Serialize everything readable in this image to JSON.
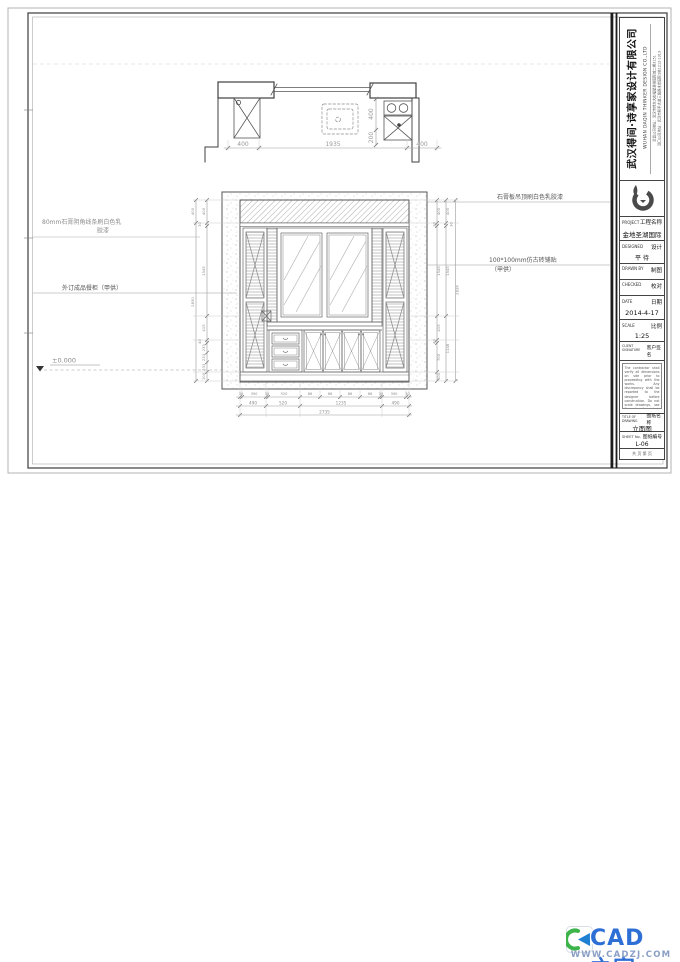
{
  "plan": {
    "dims_bottom": [
      "400",
      "1935",
      "400"
    ],
    "dims_right": [
      "400",
      "200"
    ]
  },
  "elev": {
    "left_inner": [
      "400",
      "30",
      "1545",
      "415",
      "40",
      "233",
      "233",
      "233",
      "100"
    ],
    "left_outer": [
      "400",
      "2830"
    ],
    "right_inner": [
      "400",
      "30",
      "1545",
      "415",
      "40",
      "700",
      "100"
    ],
    "right_outer": [
      "400",
      "30",
      "1545",
      "1148"
    ],
    "right_overall": "2836",
    "bottom_row1": [
      "30",
      "390",
      "30",
      "520",
      "86",
      "86",
      "86",
      "86",
      "30",
      "390",
      "30"
    ],
    "bottom_row2": [
      "490",
      "520",
      "1235",
      "490"
    ],
    "bottom_overall": "2735"
  },
  "ann": {
    "left1a": "80mm石膏阴角线条刷白色乳",
    "left1b": "胶漆",
    "left2": "外订成品餐柜（甲供）",
    "right1": "石膏板吊顶刷白色乳胶漆",
    "right2a": "100*100mm仿古砖铺贴",
    "right2b": "（甲供）",
    "level": "±0.000"
  },
  "tb": {
    "company_cn": "武汉得间·诗享家设计有限公司",
    "company_en": "WUHAN DAQIN THINKER DESIGN CO.,LTD",
    "address1": "武昌公司地址：武汉市徐东大街福星惠誉国际城二期3151",
    "address2": "汉口公司地址：武汉市和平大道三角路水岸国际2栋1212-1313",
    "project_en": "PROJECT",
    "project_cn": "工程名称",
    "project_name": "金地圣湖国际",
    "designed_en": "DESIGNED",
    "designed_cn": "设计",
    "designed_value": "平 待",
    "drawn_en": "DRAWN BY",
    "drawn_cn": "制图",
    "checked_en": "CHECKED",
    "checked_cn": "校对",
    "date_en": "DATE",
    "date_cn": "日期",
    "date_value": "2014-4-17",
    "scale_en": "SCALE",
    "scale_cn": "比例",
    "scale_value": "1:25",
    "client_en": "CLIENT SIGNATURE",
    "client_cn": "客户签名",
    "notes_en": "The contractor shall verify all dimensions on site prior to proceeding with the works. Any discrepancy shall be reported to the designer before construction. Do not scale drawings, use figured dimensions only.",
    "notes_cn": "本图纸版权归本公司所有，未经许可不得复制、转载或用于其他工程，施工前请核对现场尺寸。",
    "title_en": "TITLE OF DRAWING",
    "title_cn": "图纸名称",
    "title_value": "立面图",
    "sheet_en": "SHEET No.",
    "sheet_cn": "图纸编号",
    "sheet_value": "L-06",
    "page_row": "共  页  第  页"
  },
  "wm": {
    "text": "CAD之家",
    "url": "WWW.CADZJ.COM",
    "blue": "#2e6fd6",
    "green": "#3cb44a"
  }
}
